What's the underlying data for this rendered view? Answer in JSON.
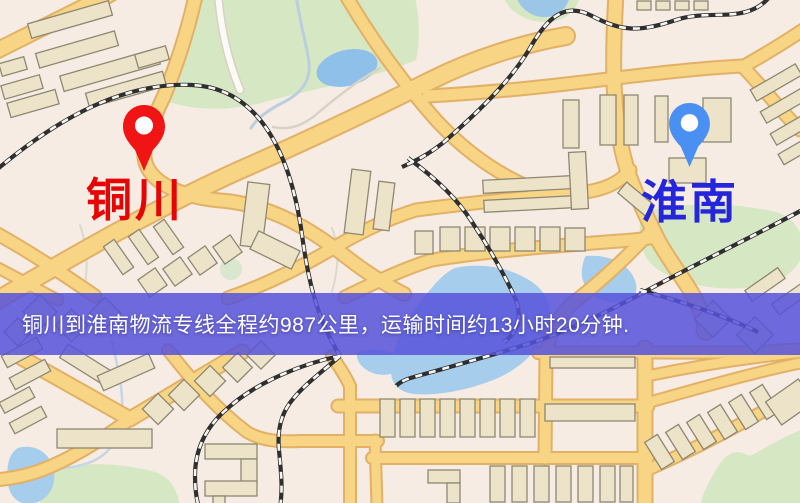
{
  "map": {
    "origin": {
      "label": "铜川",
      "label_color": "#e60505",
      "pin_color": "#f01414"
    },
    "destination": {
      "label": "淮南",
      "label_color": "#2525dc",
      "pin_color": "#4a90f2"
    },
    "banner": {
      "text": "铜川到淮南物流专线全程约987公里，运输时间约13小时20分钟.",
      "background_color": "#5652db",
      "text_color": "#ffffff"
    },
    "icons": {
      "origin_pin": "map-pin-icon",
      "destination_pin": "map-pin-icon"
    }
  }
}
